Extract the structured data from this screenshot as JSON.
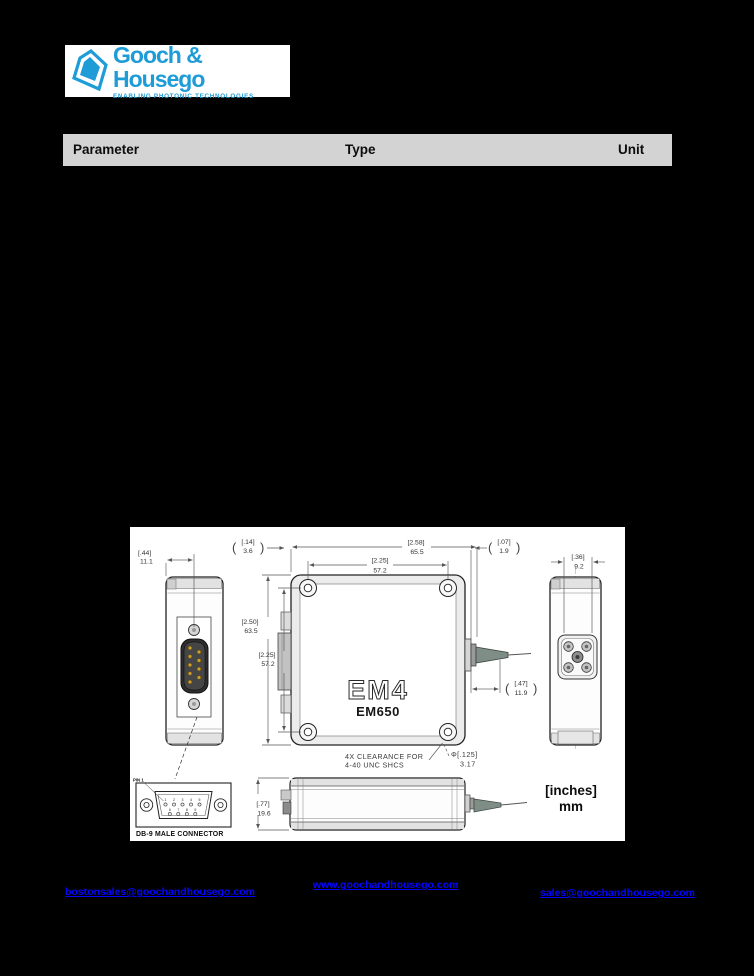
{
  "logo": {
    "brand": "Gooch & Housego",
    "tagline": "ENABLING PHOTONIC TECHNOLOGIES",
    "brand_color": "#1e9cd7"
  },
  "table": {
    "header_bg": "#d3d3d3",
    "columns": [
      "Parameter",
      "Type",
      "Unit"
    ]
  },
  "drawing": {
    "product_label": "EM4",
    "model_label": "EM650",
    "glyphs": {
      "paren_open": "(",
      "paren_close": ")"
    },
    "dims": {
      "d44": {
        "in": "[.44]",
        "mm": "11.1"
      },
      "d14": {
        "in": "[.14]",
        "mm": "3.6"
      },
      "d258": {
        "in": "[2.58]",
        "mm": "65.5"
      },
      "d07": {
        "in": "[.07]",
        "mm": "1.9"
      },
      "d225t": {
        "in": "[2.25]",
        "mm": "57.2"
      },
      "d36": {
        "in": "[.36]",
        "mm": "9.2"
      },
      "d250": {
        "in": "[2.50]",
        "mm": "63.5"
      },
      "d225l": {
        "in": "[2.25]",
        "mm": "57.2"
      },
      "d47": {
        "in": "[.47]",
        "mm": "11.9"
      },
      "d125": {
        "in": "Φ[.125]",
        "mm": "3.17"
      },
      "d77": {
        "in": "[.77]",
        "mm": "19.6"
      }
    },
    "notes": {
      "clearance_line1": "4X CLEARANCE FOR",
      "clearance_line2": "4-40 UNC SHCS",
      "pin1": "PIN 1",
      "db9_label": "DB-9 MALE CONNECTOR"
    },
    "pins": {
      "top": [
        "1",
        "2",
        "3",
        "4",
        "5"
      ],
      "bottom": [
        "6",
        "7",
        "8",
        "9"
      ]
    },
    "units": {
      "line1": "[inches]",
      "line2": "mm"
    }
  },
  "footer": {
    "link_color": "#0504ff",
    "links": [
      {
        "label": "bostonsales@goochandhousego.com"
      },
      {
        "label": "www.goochandhousego.com"
      },
      {
        "label": "sales@goochandhousego.com"
      }
    ]
  }
}
